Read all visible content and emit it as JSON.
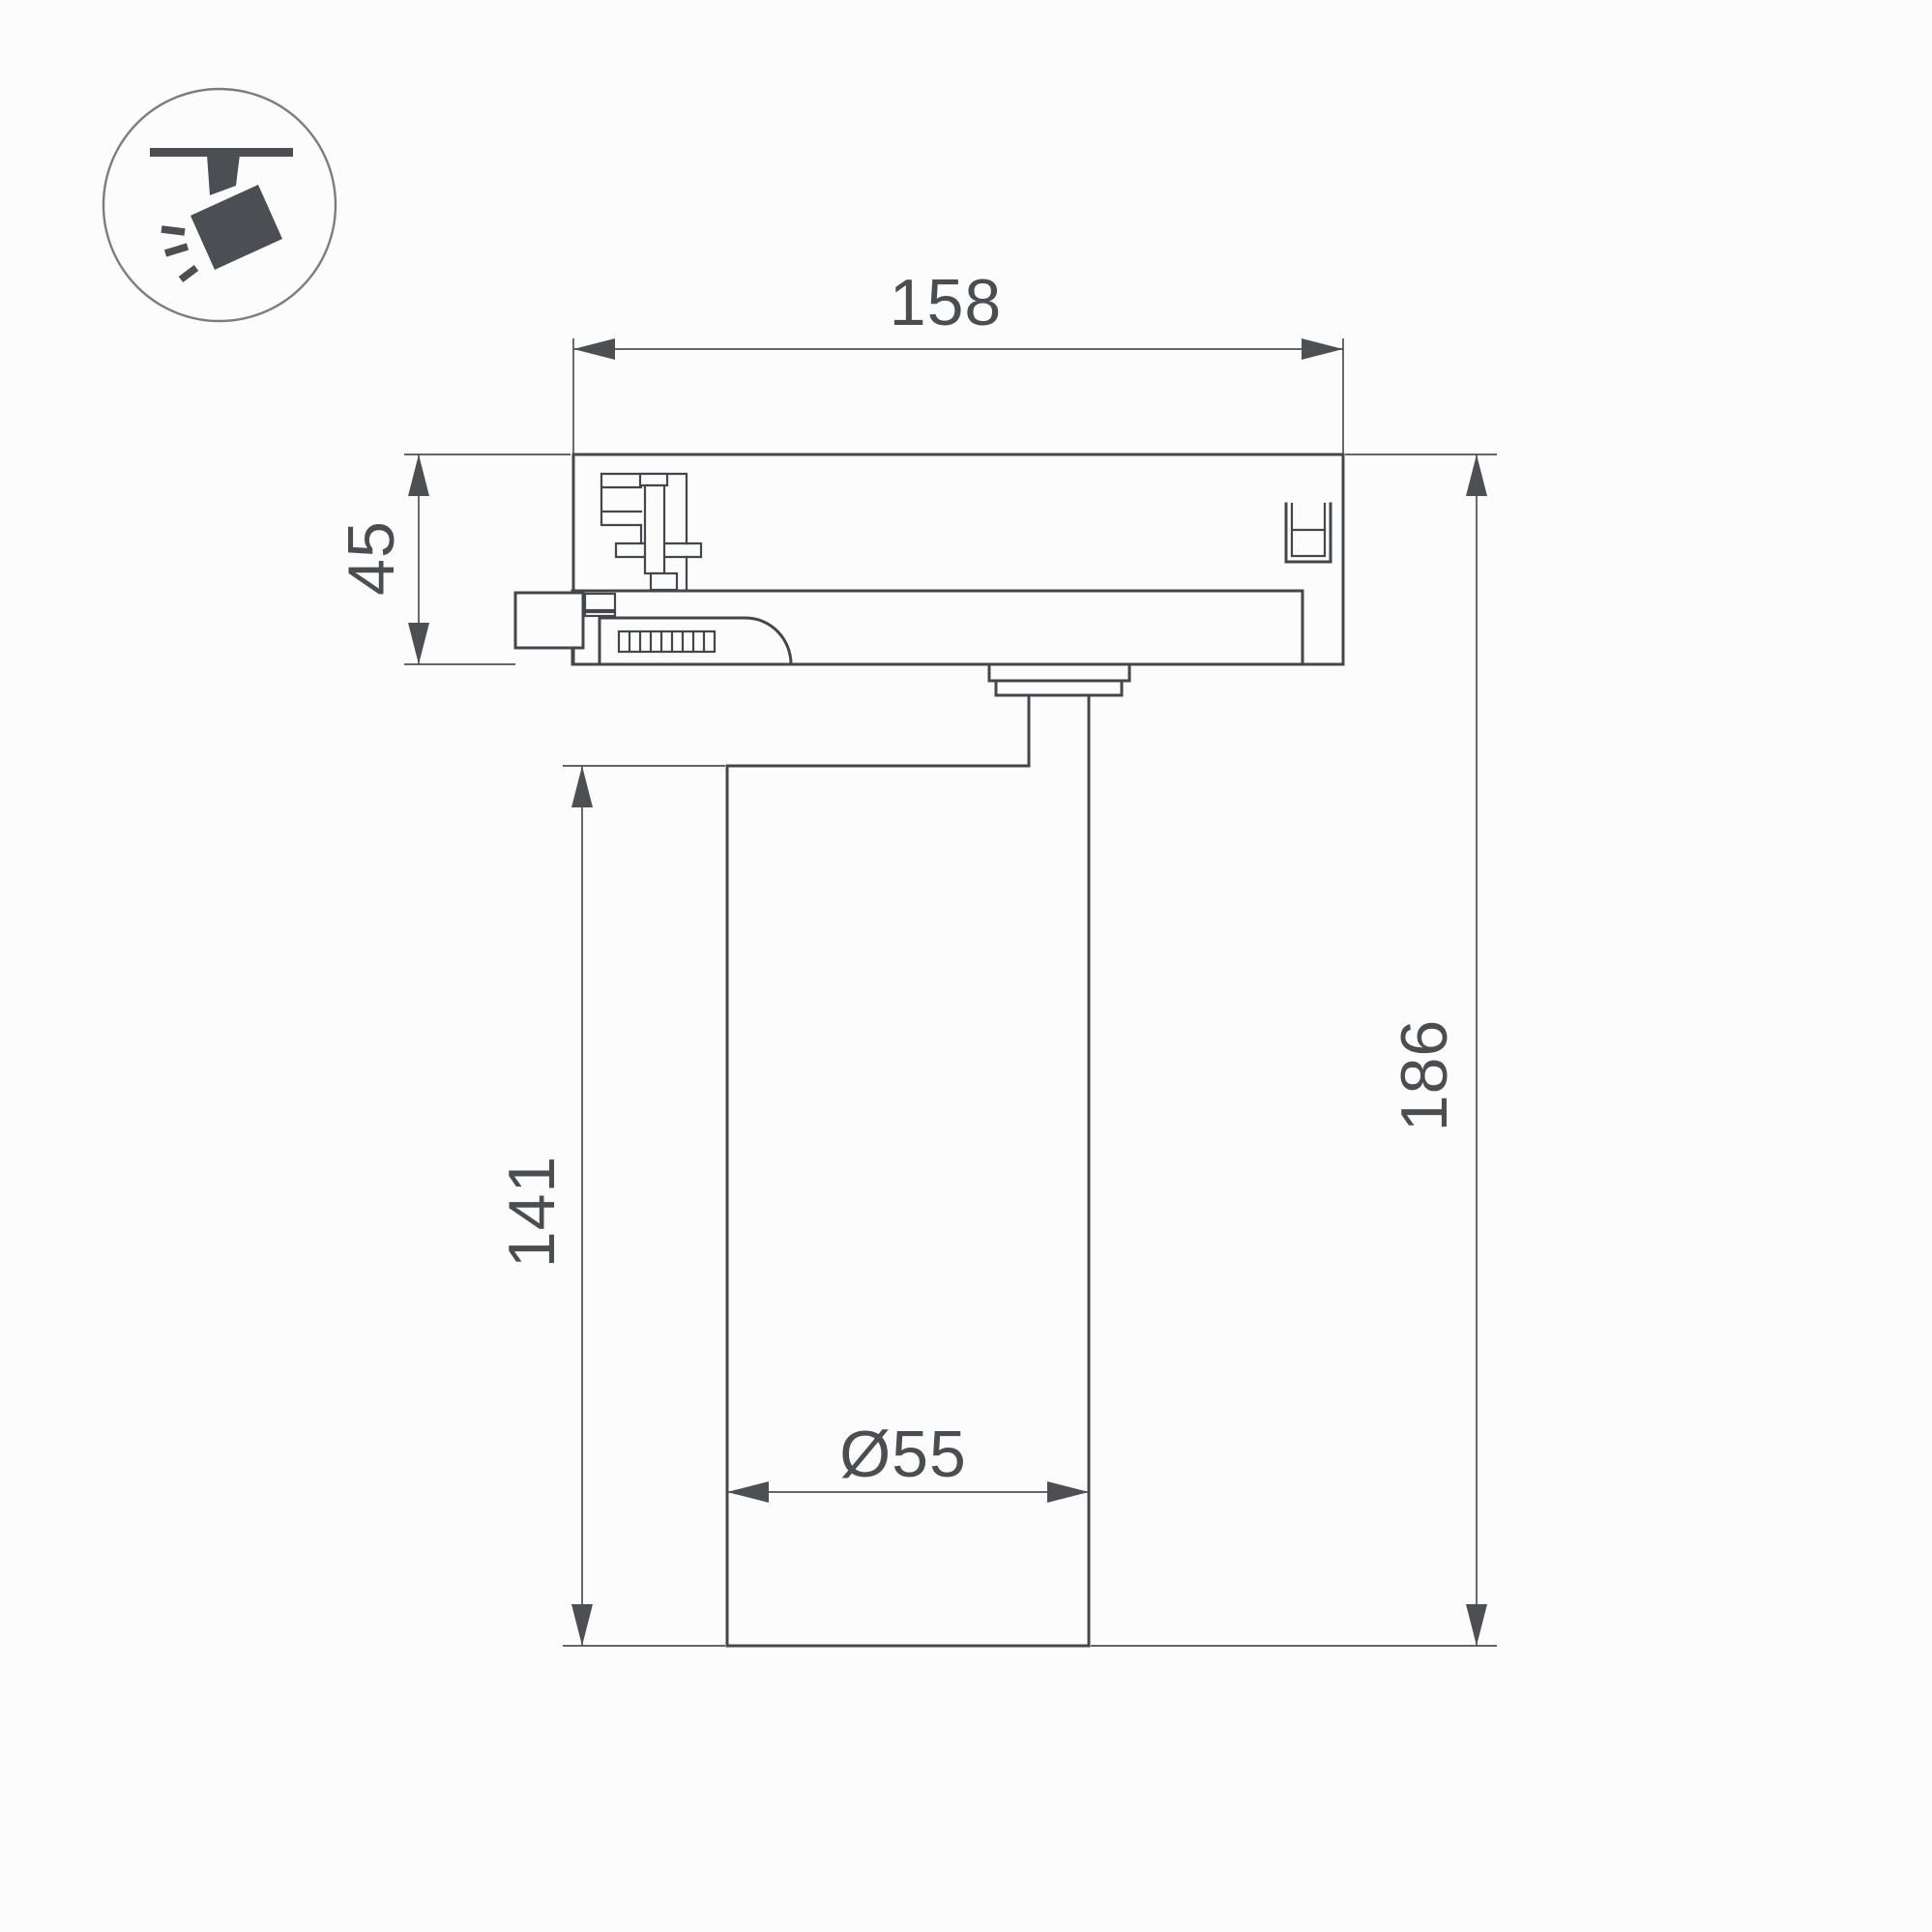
{
  "icon_badge": {
    "name": "track-spotlight-icon"
  },
  "dimensions": {
    "adapter_width": "158",
    "adapter_height": "45",
    "body_height": "141",
    "total_height": "186",
    "body_diameter": "Ø55"
  },
  "colors": {
    "line": "#43474b",
    "dimension": "#4d5053",
    "label_text": "#4b4e51",
    "icon": "#4b4f54",
    "background": "#fcfcfc"
  }
}
